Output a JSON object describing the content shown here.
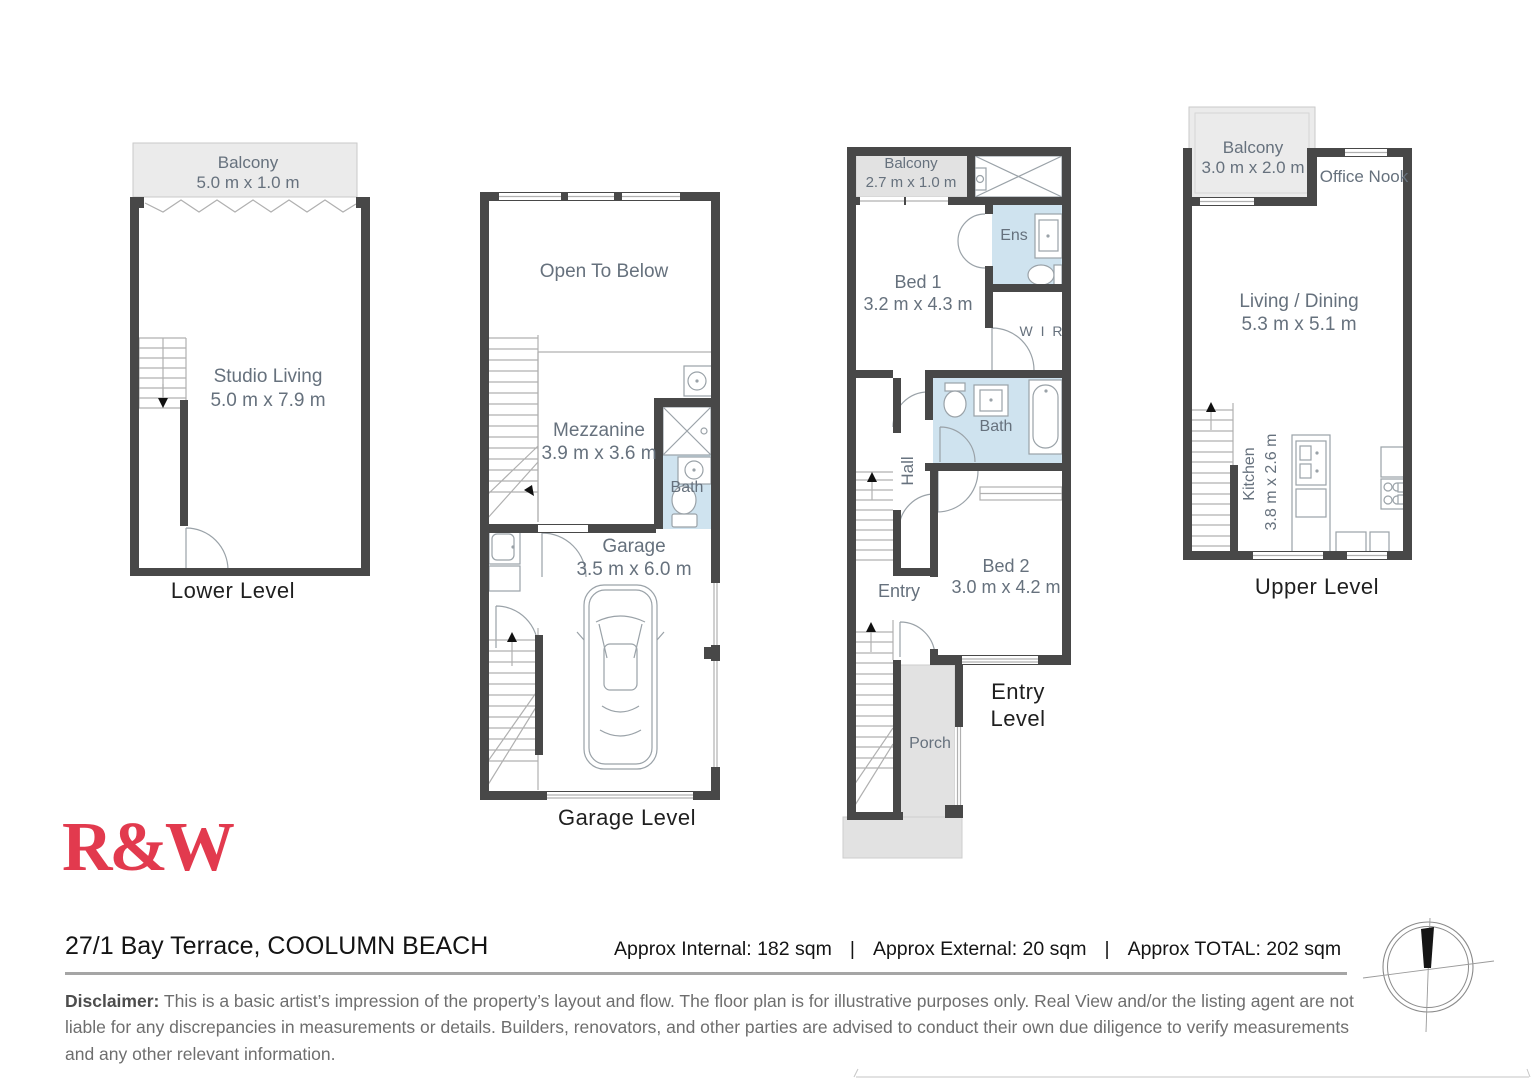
{
  "colors": {
    "wall": "#484848",
    "wet_area_blue": "#cfe3ef",
    "balcony_gray": "#ebebeb",
    "porch_gray": "#e2e2e2",
    "room_text": "#66717d",
    "brand_red": "#e23a4e"
  },
  "plans": {
    "lower": {
      "label": "Lower Level",
      "balcony_name": "Balcony",
      "balcony_dims": "5.0 m x 1.0 m",
      "room_name": "Studio Living",
      "room_dims": "5.0 m x 7.9 m"
    },
    "garage": {
      "label": "Garage Level",
      "open_below": "Open To Below",
      "mezz_name": "Mezzanine",
      "mezz_dims": "3.9 m x 3.6 m",
      "bath": "Bath",
      "garage_name": "Garage",
      "garage_dims": "3.5 m x 6.0 m"
    },
    "entry": {
      "label_line1": "Entry",
      "label_line2": "Level",
      "balcony_name": "Balcony",
      "balcony_dims": "2.7 m x 1.0 m",
      "bed1_name": "Bed 1",
      "bed1_dims": "3.2 m x 4.3 m",
      "ens": "Ens",
      "wir": "W I R",
      "bath": "Bath",
      "hall": "Hall",
      "entry": "Entry",
      "bed2_name": "Bed 2",
      "bed2_dims": "3.0 m x 4.2 m",
      "porch": "Porch"
    },
    "upper": {
      "label": "Upper Level",
      "balcony_name": "Balcony",
      "balcony_dims": "3.0 m x 2.0 m",
      "office_nook": "Office Nook",
      "living_name": "Living / Dining",
      "living_dims": "5.3 m x 5.1 m",
      "kitchen_name": "Kitchen",
      "kitchen_dims": "3.8 m x 2.6 m"
    }
  },
  "footer": {
    "brand": "R&W",
    "address": "27/1 Bay Terrace, COOLUMN BEACH",
    "internal": "Approx Internal: 182 sqm",
    "sep1": "|",
    "external": "Approx External: 20 sqm",
    "sep2": "|",
    "total": "Approx TOTAL: 202 sqm",
    "disclaimer_label": "Disclaimer:",
    "disclaimer_text": "This is a basic artist’s impression of the property’s layout and flow. The floor plan is for illustrative purposes only. Real View and/or the listing agent are not liable for any discrepancies in measurements or details. Builders, renovators, and other parties are advised to conduct their own due diligence to verify measurements and any other relevant information."
  }
}
